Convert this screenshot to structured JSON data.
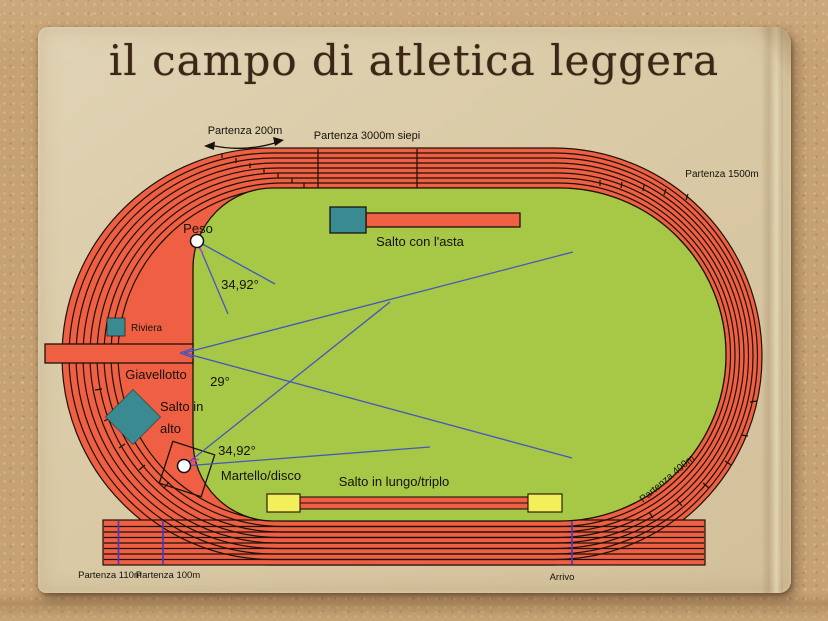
{
  "page": {
    "title": "il campo di atletica leggera"
  },
  "colors": {
    "cork_background": "#c6a173",
    "paper": "#d9c9a7",
    "track_red": "#ee5f43",
    "infield_green": "#a6c846",
    "pad_teal": "#398a91",
    "board_yellow": "#f3ef5a",
    "sector_line_blue": "#4556bd",
    "start_line_purple": "#4a3ac2",
    "outline_black": "#1c1208",
    "title_brown": "#3c2716",
    "accent_magenta": "#cc3fcc"
  },
  "track_labels": {
    "partenza_200m": "Partenza 200m",
    "partenza_3000m_siepi": "Partenza 3000m siepi",
    "partenza_1500m": "Partenza 1500m",
    "partenza_400m": "Partenza 400m",
    "partenza_110m": "Partenza 110m",
    "partenza_100m": "Partenza 100m",
    "arrivo": "Arrivo"
  },
  "field_labels": {
    "peso": "Peso",
    "peso_sector_angle": "34,92°",
    "salto_con_asta": "Salto con l'asta",
    "riviera": "Riviera",
    "giavellotto": "Giavellotto",
    "giavellotto_sector_angle": "29°",
    "salto_in_alto_line1": "Salto in",
    "salto_in_alto_line2": "alto",
    "martello_sector_angle": "34,92°",
    "martello_disco": "Martello/disco",
    "salto_in_lungo_triplo": "Salto in lungo/triplo"
  }
}
